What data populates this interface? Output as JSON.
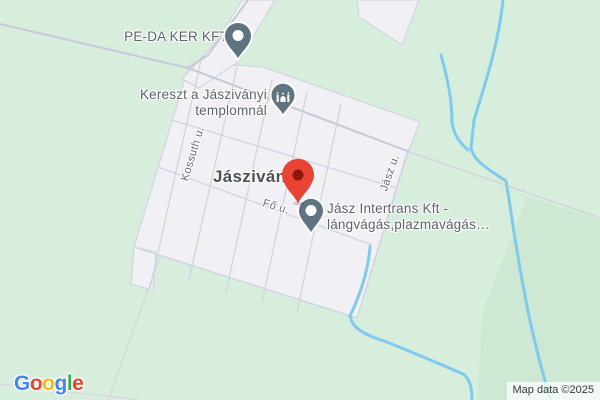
{
  "town": {
    "name": "Jászivány"
  },
  "pois": {
    "peda": {
      "name": "PE-DA KER KFT"
    },
    "kereszt": {
      "line1": "Kereszt a Jásziványi",
      "line2": "templomnál"
    },
    "intertrans": {
      "line1": "Jász Intertrans Kft -",
      "line2": "lángvágás,plazmavágás…"
    }
  },
  "streets": {
    "kossuth": "Kossuth u.",
    "fo": "Fő u.",
    "jasz": "Jász u."
  },
  "google_logo": {
    "letters": [
      "G",
      "o",
      "o",
      "g",
      "l",
      "e"
    ]
  },
  "attribution": "Map data ©2025",
  "colors": {
    "land_green": "#d7eedd",
    "field_green_dark": "#cde8d3",
    "builtup_white": "#f1f0f4",
    "road_gray": "#c6cad7",
    "street_gray": "#ced2de",
    "water_blue": "#7fcaed",
    "boundary_faint": "#d8d2de",
    "poi_pin_slate": "#5f7381",
    "destination_pin_red": "#e94335",
    "destination_pin_core": "#8f160c",
    "label_gray": "#5d646b",
    "town_label": "#4d5257"
  }
}
